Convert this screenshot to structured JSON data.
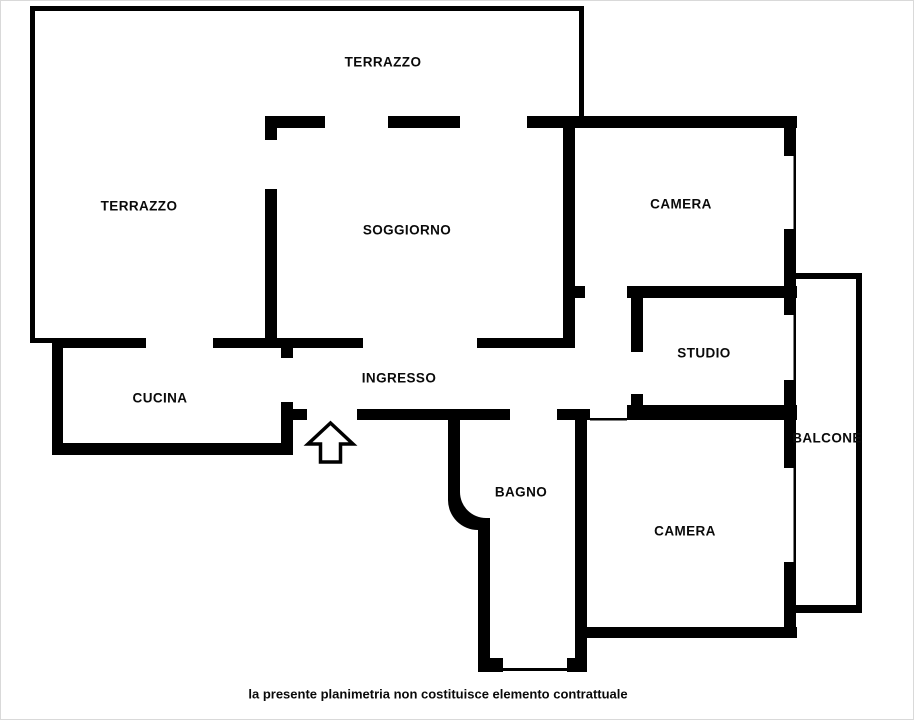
{
  "plan": {
    "title": "planimetria",
    "wall_color": "#000000",
    "background_color": "#ffffff",
    "rooms": [
      {
        "id": "terrazzo-top",
        "label": "TERRAZZO"
      },
      {
        "id": "terrazzo-side",
        "label": "TERRAZZO"
      },
      {
        "id": "soggiorno",
        "label": "SOGGIORNO"
      },
      {
        "id": "camera-1",
        "label": "CAMERA"
      },
      {
        "id": "studio",
        "label": "STUDIO"
      },
      {
        "id": "balcone",
        "label": "BALCONE"
      },
      {
        "id": "cucina",
        "label": "CUCINA"
      },
      {
        "id": "ingresso",
        "label": "INGRESSO"
      },
      {
        "id": "bagno",
        "label": "BAGNO"
      },
      {
        "id": "camera-2",
        "label": "CAMERA"
      }
    ],
    "entrance_icon": "up-arrow",
    "disclaimer": "la presente planimetria non costituisce elemento contrattuale"
  }
}
